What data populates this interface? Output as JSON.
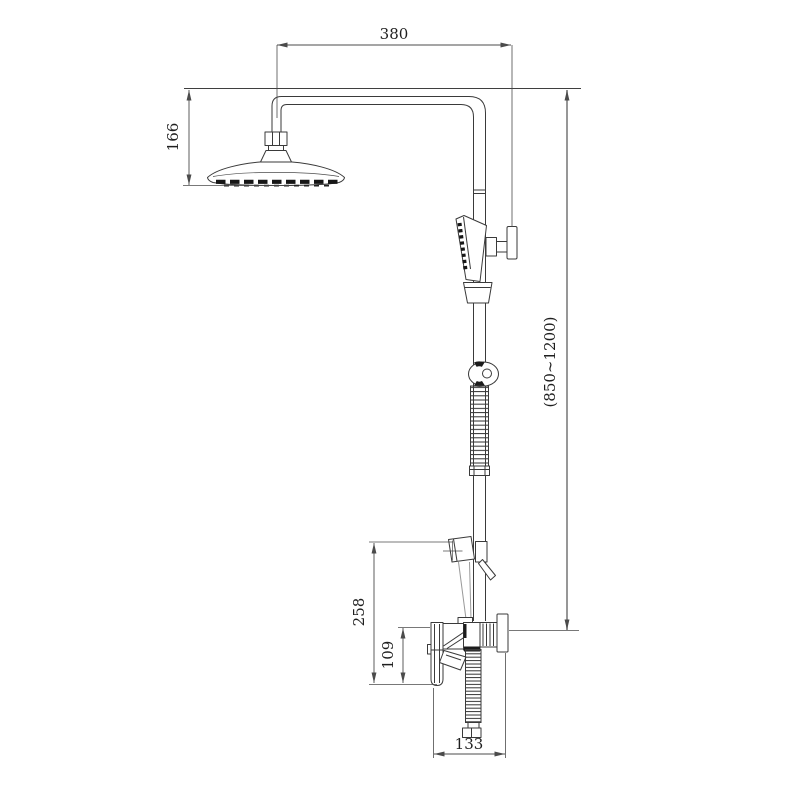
{
  "drawing": {
    "colors": {
      "background": "#ffffff",
      "part_line": "#3a3a3a",
      "dimension_line": "#4b4b4b",
      "range_line": "#7d7d7d",
      "text": "#1f1f1f",
      "dark_fill": "#1c1c1c"
    },
    "dimensions": {
      "arm_reach": {
        "label": "380"
      },
      "head_drop": {
        "label": "166"
      },
      "height_range": {
        "label": "(850~1200)"
      },
      "mixer_top_height": {
        "label": "258"
      },
      "mixer_inlet_height": {
        "label": "109"
      },
      "mixer_depth": {
        "label": "133"
      }
    }
  }
}
